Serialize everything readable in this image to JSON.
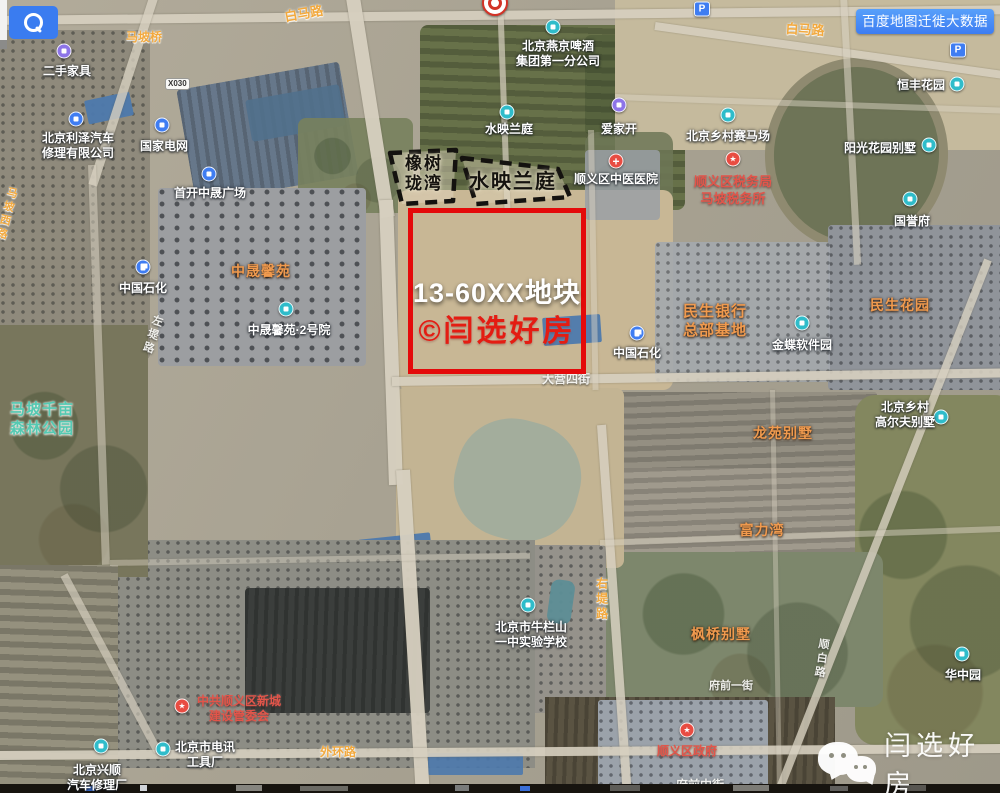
{
  "ui": {
    "migration_button_label": "百度地图迁徙大数据"
  },
  "plot": {
    "name": "13-60XX地块",
    "credit": "©闫选好房",
    "border_color": "#e40a0a"
  },
  "dashed_zones": [
    "橡树珑湾",
    "水映兰庭"
  ],
  "road_shield": {
    "code": "X030"
  },
  "watermark": {
    "brand_text": "闫选好房"
  },
  "colors": {
    "plot_border": "#e40a0a",
    "credit_red": "#e41c12",
    "button_blue": "#3d7df2",
    "poi_white": "#ffffff",
    "area_orange": "#f09a4e",
    "gov_red": "#e2554a",
    "park_teal": "#55c9b2",
    "road_orange": "#f2a93e",
    "icon_teal": "#2fbcca",
    "icon_blue": "#3f7df2",
    "icon_purple": "#8d74e8",
    "icon_red": "#e84c42"
  },
  "map_labels": [
    {
      "style": "poi",
      "lines": [
        "二手家具"
      ],
      "x": 67,
      "y": 64
    },
    {
      "style": "poi",
      "lines": [
        "北京利泽汽车",
        "修理有限公司"
      ],
      "x": 78,
      "y": 131
    },
    {
      "style": "poi",
      "lines": [
        "国家电网"
      ],
      "x": 164,
      "y": 139
    },
    {
      "style": "poi",
      "lines": [
        "首开中晟广场"
      ],
      "x": 210,
      "y": 186
    },
    {
      "style": "poi",
      "lines": [
        "中晟馨苑·2号院"
      ],
      "x": 289,
      "y": 323
    },
    {
      "style": "poi",
      "lines": [
        "水映兰庭"
      ],
      "x": 509,
      "y": 122
    },
    {
      "style": "poi",
      "lines": [
        "爱家开"
      ],
      "x": 619,
      "y": 122
    },
    {
      "style": "poi",
      "lines": [
        "北京燕京啤酒",
        "集团第一分公司"
      ],
      "x": 558,
      "y": 39
    },
    {
      "style": "poi",
      "lines": [
        "顺义区中医医院"
      ],
      "x": 616,
      "y": 172
    },
    {
      "style": "poi",
      "lines": [
        "北京乡村赛马场"
      ],
      "x": 728,
      "y": 129
    },
    {
      "style": "poi",
      "lines": [
        "恒丰花园"
      ],
      "x": 921,
      "y": 78
    },
    {
      "style": "poi",
      "lines": [
        "阳光花园别墅"
      ],
      "x": 880,
      "y": 141
    },
    {
      "style": "poi",
      "lines": [
        "国誉府"
      ],
      "x": 912,
      "y": 214
    },
    {
      "style": "poi",
      "lines": [
        "金蝶软件园"
      ],
      "x": 802,
      "y": 338
    },
    {
      "style": "poi",
      "lines": [
        "中国石化"
      ],
      "x": 143,
      "y": 281
    },
    {
      "style": "poi",
      "lines": [
        "中国石化"
      ],
      "x": 637,
      "y": 346
    },
    {
      "style": "poi",
      "lines": [
        "北京乡村",
        "高尔夫别墅"
      ],
      "x": 905,
      "y": 400
    },
    {
      "style": "poi",
      "lines": [
        "华中园"
      ],
      "x": 963,
      "y": 668
    },
    {
      "style": "poi",
      "lines": [
        "北京市牛栏山",
        "一中实验学校"
      ],
      "x": 531,
      "y": 620
    },
    {
      "style": "poi",
      "lines": [
        "北京市电讯",
        "工具厂"
      ],
      "x": 205,
      "y": 740
    },
    {
      "style": "poi",
      "lines": [
        "北京兴顺",
        "汽车修理厂"
      ],
      "x": 97,
      "y": 763
    },
    {
      "style": "area",
      "lines": [
        "中晟馨苑"
      ],
      "x": 261,
      "y": 263
    },
    {
      "style": "area",
      "lines": [
        "民生银行",
        "总部基地"
      ],
      "x": 715,
      "y": 302,
      "size": 15
    },
    {
      "style": "area",
      "lines": [
        "民生花园"
      ],
      "x": 900,
      "y": 297
    },
    {
      "style": "area",
      "lines": [
        "龙苑别墅"
      ],
      "x": 783,
      "y": 425
    },
    {
      "style": "area",
      "lines": [
        "富力湾"
      ],
      "x": 762,
      "y": 522
    },
    {
      "style": "area",
      "lines": [
        "枫桥别墅"
      ],
      "x": 721,
      "y": 626
    },
    {
      "style": "gov",
      "lines": [
        "顺义区税务局",
        "马坡税务所"
      ],
      "x": 733,
      "y": 174,
      "size": 13
    },
    {
      "style": "gov",
      "lines": [
        "中共顺义区新城",
        "建设管委会"
      ],
      "x": 239,
      "y": 694
    },
    {
      "style": "gov",
      "lines": [
        "顺义区政府"
      ],
      "x": 687,
      "y": 744
    },
    {
      "style": "park",
      "lines": [
        "马坡千亩",
        "森林公园"
      ],
      "x": 42,
      "y": 400
    },
    {
      "style": "road",
      "lines": [
        "马坡桥"
      ],
      "x": 144,
      "y": 30
    },
    {
      "style": "road",
      "lines": [
        "白马路"
      ],
      "x": 304,
      "y": 6,
      "rotate": -10,
      "size": 13
    },
    {
      "style": "road",
      "lines": [
        "白马路"
      ],
      "x": 805,
      "y": 22,
      "rotate": 3,
      "size": 13
    },
    {
      "style": "road",
      "lines": [
        "外环路"
      ],
      "x": 338,
      "y": 745
    },
    {
      "style": "road",
      "lines": [
        "右堤路"
      ],
      "x": 601,
      "y": 577,
      "vertical": true
    },
    {
      "style": "road",
      "lines": [
        "马坡西路"
      ],
      "x": 6,
      "y": 186,
      "vertical": true,
      "rotate": 14,
      "size": 11
    },
    {
      "style": "roadf",
      "lines": [
        "大营四街"
      ],
      "x": 566,
      "y": 372,
      "size": 12
    },
    {
      "style": "roadf",
      "lines": [
        "府前一街"
      ],
      "x": 731,
      "y": 679
    },
    {
      "style": "roadf",
      "lines": [
        "府前中街"
      ],
      "x": 700,
      "y": 778,
      "under": true,
      "size": 12
    },
    {
      "style": "roadf",
      "lines": [
        "左堤路"
      ],
      "x": 152,
      "y": 314,
      "vertical": true,
      "rotate": 18
    },
    {
      "style": "roadf",
      "lines": [
        "顺白路"
      ],
      "x": 821,
      "y": 638,
      "vertical": true,
      "rotate": 8
    },
    {
      "style": "zone",
      "lines": [
        "橡树",
        "珑湾"
      ],
      "x": 424,
      "y": 154,
      "size": 17
    },
    {
      "style": "zone",
      "lines": [
        "水映兰庭"
      ],
      "x": 513,
      "y": 171,
      "size": 20
    }
  ],
  "map_icons": [
    {
      "type": "purple",
      "x": 64,
      "y": 51
    },
    {
      "type": "purple",
      "x": 619,
      "y": 105
    },
    {
      "type": "blue",
      "x": 76,
      "y": 119
    },
    {
      "type": "blue",
      "x": 162,
      "y": 125
    },
    {
      "type": "blue",
      "x": 209,
      "y": 174
    },
    {
      "type": "teal",
      "x": 553,
      "y": 27
    },
    {
      "type": "teal",
      "x": 507,
      "y": 112
    },
    {
      "type": "teal",
      "x": 728,
      "y": 115
    },
    {
      "type": "teal",
      "x": 957,
      "y": 84
    },
    {
      "type": "teal",
      "x": 929,
      "y": 145
    },
    {
      "type": "teal",
      "x": 910,
      "y": 199
    },
    {
      "type": "teal",
      "x": 802,
      "y": 323
    },
    {
      "type": "teal",
      "x": 941,
      "y": 417
    },
    {
      "type": "teal",
      "x": 962,
      "y": 654
    },
    {
      "type": "teal",
      "x": 528,
      "y": 605
    },
    {
      "type": "teal",
      "x": 163,
      "y": 749
    },
    {
      "type": "teal",
      "x": 101,
      "y": 746
    },
    {
      "type": "teal",
      "x": 286,
      "y": 309
    },
    {
      "type": "redcross",
      "x": 616,
      "y": 161
    },
    {
      "type": "redstar",
      "x": 733,
      "y": 159
    },
    {
      "type": "redstar",
      "x": 182,
      "y": 706
    },
    {
      "type": "redstar",
      "x": 687,
      "y": 730
    },
    {
      "type": "fuel",
      "x": 143,
      "y": 267
    },
    {
      "type": "fuel",
      "x": 637,
      "y": 333
    },
    {
      "type": "parking",
      "x": 702,
      "y": 9
    },
    {
      "type": "parking",
      "x": 958,
      "y": 50
    },
    {
      "type": "target",
      "x": 495,
      "y": 3
    }
  ]
}
